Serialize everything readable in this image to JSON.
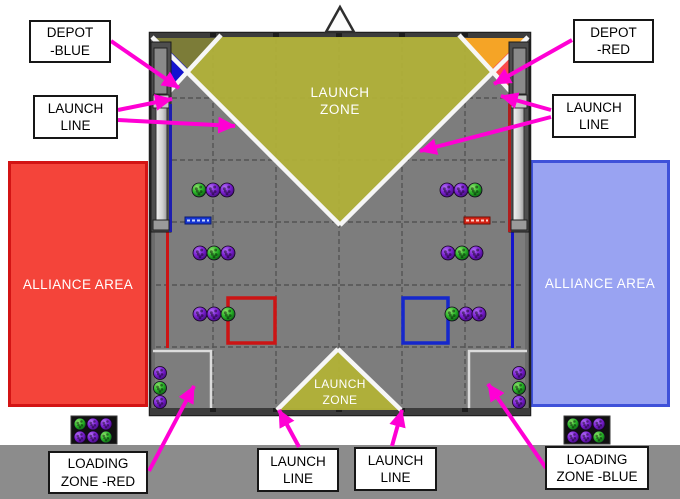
{
  "colors": {
    "magenta_arrow": "#ff00d4",
    "launch_zone_yellow": "#b2b237",
    "field_gray": "#7d7d7d",
    "alliance_red": "#f4443a",
    "alliance_blue": "#99a3f2",
    "depot_blue": "#1212cf",
    "depot_red": "#fb4a4a",
    "ramp_orange": "#f5a426",
    "ball_purple": "#7a1fd0",
    "ball_green": "#28b428"
  },
  "field": {
    "launch_zone_top": "LAUNCH\nZONE",
    "launch_zone_bottom": "LAUNCH\nZONE",
    "alliance_area_left": "ALLIANCE AREA",
    "alliance_area_right": "ALLIANCE AREA"
  },
  "callouts": [
    {
      "id": "depot-blue",
      "text": "DEPOT\n-BLUE",
      "x": 29,
      "y": 20,
      "w": 82,
      "h": 43,
      "arrows": [
        [
          111,
          41,
          179,
          88
        ]
      ]
    },
    {
      "id": "launch-line-top-left",
      "text": "LAUNCH\nLINE",
      "x": 33,
      "y": 95,
      "w": 85,
      "h": 44,
      "arrows": [
        [
          118,
          110,
          172,
          99
        ],
        [
          118,
          120,
          235,
          126
        ]
      ]
    },
    {
      "id": "depot-red",
      "text": "DEPOT\n-RED",
      "x": 573,
      "y": 19,
      "w": 81,
      "h": 44,
      "arrows": [
        [
          572,
          40,
          494,
          84
        ]
      ]
    },
    {
      "id": "launch-line-top-right",
      "text": "LAUNCH\nLINE",
      "x": 552,
      "y": 94,
      "w": 84,
      "h": 44,
      "arrows": [
        [
          551,
          110,
          501,
          96
        ],
        [
          551,
          117,
          420,
          151
        ]
      ]
    },
    {
      "id": "loading-zone-red",
      "text": "LOADING\nZONE -RED",
      "x": 48,
      "y": 451,
      "w": 100,
      "h": 43,
      "arrows": [
        [
          149,
          471,
          194,
          386
        ]
      ]
    },
    {
      "id": "launch-line-bottom-left",
      "text": "LAUNCH\nLINE",
      "x": 257,
      "y": 448,
      "w": 82,
      "h": 44,
      "arrows": [
        [
          299,
          447,
          279,
          410
        ]
      ]
    },
    {
      "id": "launch-line-bottom-right",
      "text": "LAUNCH\nLINE",
      "x": 354,
      "y": 447,
      "w": 83,
      "h": 44,
      "arrows": [
        [
          392,
          446,
          402,
          410
        ]
      ]
    },
    {
      "id": "loading-zone-blue",
      "text": "LOADING\nZONE -BLUE",
      "x": 545,
      "y": 446,
      "w": 104,
      "h": 44,
      "arrows": [
        [
          546,
          468,
          488,
          384
        ]
      ]
    }
  ],
  "balls": [
    {
      "x": 199,
      "y": 190,
      "r": 7,
      "c": "green"
    },
    {
      "x": 213,
      "y": 190,
      "r": 7,
      "c": "purple"
    },
    {
      "x": 227,
      "y": 190,
      "r": 7,
      "c": "purple"
    },
    {
      "x": 200,
      "y": 253,
      "r": 7,
      "c": "purple"
    },
    {
      "x": 214,
      "y": 253,
      "r": 7,
      "c": "green"
    },
    {
      "x": 228,
      "y": 253,
      "r": 7,
      "c": "purple"
    },
    {
      "x": 200,
      "y": 314,
      "r": 7,
      "c": "purple"
    },
    {
      "x": 214,
      "y": 314,
      "r": 7,
      "c": "purple"
    },
    {
      "x": 228,
      "y": 314,
      "r": 7,
      "c": "green"
    },
    {
      "x": 447,
      "y": 190,
      "r": 7,
      "c": "purple"
    },
    {
      "x": 461,
      "y": 190,
      "r": 7,
      "c": "purple"
    },
    {
      "x": 475,
      "y": 190,
      "r": 7,
      "c": "green"
    },
    {
      "x": 448,
      "y": 253,
      "r": 7,
      "c": "purple"
    },
    {
      "x": 462,
      "y": 253,
      "r": 7,
      "c": "green"
    },
    {
      "x": 476,
      "y": 253,
      "r": 7,
      "c": "purple"
    },
    {
      "x": 452,
      "y": 314,
      "r": 7,
      "c": "green"
    },
    {
      "x": 466,
      "y": 314,
      "r": 7,
      "c": "purple"
    },
    {
      "x": 479,
      "y": 314,
      "r": 7,
      "c": "purple"
    },
    {
      "x": 160,
      "y": 373,
      "r": 6.5,
      "c": "purple"
    },
    {
      "x": 160,
      "y": 388,
      "r": 6.5,
      "c": "green"
    },
    {
      "x": 160,
      "y": 402,
      "r": 6.5,
      "c": "purple"
    },
    {
      "x": 519,
      "y": 373,
      "r": 6.5,
      "c": "purple"
    },
    {
      "x": 519,
      "y": 388,
      "r": 6.5,
      "c": "green"
    },
    {
      "x": 519,
      "y": 402,
      "r": 6.5,
      "c": "purple"
    },
    {
      "x": 80,
      "y": 424,
      "r": 6,
      "c": "green"
    },
    {
      "x": 93,
      "y": 424,
      "r": 6,
      "c": "purple"
    },
    {
      "x": 106,
      "y": 424,
      "r": 6,
      "c": "purple"
    },
    {
      "x": 80,
      "y": 437,
      "r": 6,
      "c": "purple"
    },
    {
      "x": 93,
      "y": 437,
      "r": 6,
      "c": "purple"
    },
    {
      "x": 106,
      "y": 437,
      "r": 6,
      "c": "green"
    },
    {
      "x": 573,
      "y": 424,
      "r": 6,
      "c": "green"
    },
    {
      "x": 586,
      "y": 424,
      "r": 6,
      "c": "purple"
    },
    {
      "x": 599,
      "y": 424,
      "r": 6,
      "c": "purple"
    },
    {
      "x": 573,
      "y": 437,
      "r": 6,
      "c": "purple"
    },
    {
      "x": 586,
      "y": 437,
      "r": 6,
      "c": "purple"
    },
    {
      "x": 599,
      "y": 437,
      "r": 6,
      "c": "green"
    }
  ]
}
